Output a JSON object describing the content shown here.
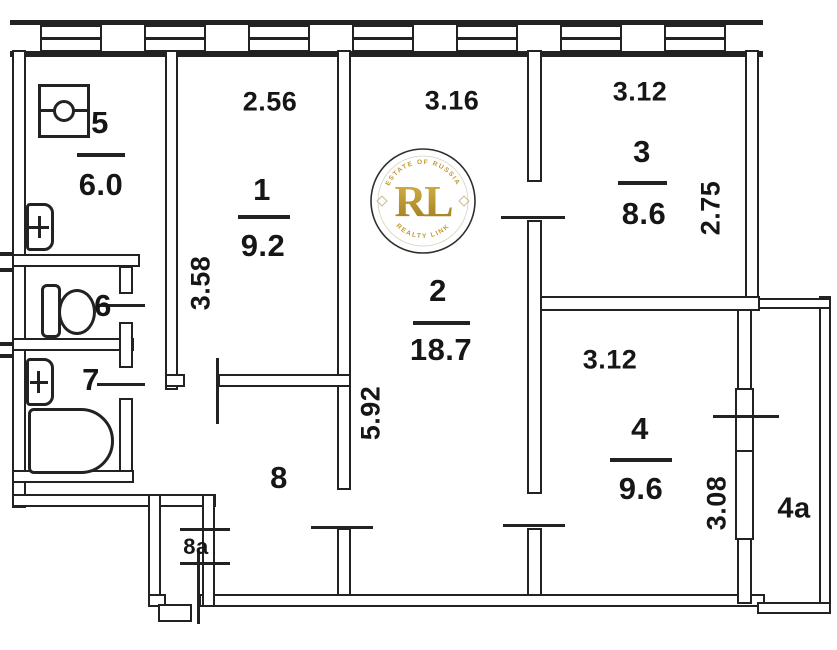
{
  "rooms": {
    "r1": {
      "number": "1",
      "area": "9.2"
    },
    "r2": {
      "number": "2",
      "area": "18.7"
    },
    "r3": {
      "number": "3",
      "area": "8.6"
    },
    "r4": {
      "number": "4",
      "area": "9.6"
    },
    "r5": {
      "number": "5",
      "area": "6.0"
    },
    "r6": {
      "number": "6"
    },
    "r7": {
      "number": "7"
    },
    "r8": {
      "number": "8"
    },
    "r8a": {
      "number": "8a"
    },
    "r4a": {
      "number": "4a"
    }
  },
  "dimensions": {
    "room1_width": "2.56",
    "room1_depth": "3.58",
    "room2_width": "3.16",
    "room2_depth": "5.92",
    "room3_width": "3.12",
    "room3_depth": "2.75",
    "room4_width": "3.12",
    "room4_depth": "3.08"
  },
  "watermark": {
    "initials": "RL",
    "arc_top": "ESTATE OF RUSSIA",
    "arc_bottom": "REALTY LINK",
    "gold_color": "#c3992f"
  }
}
